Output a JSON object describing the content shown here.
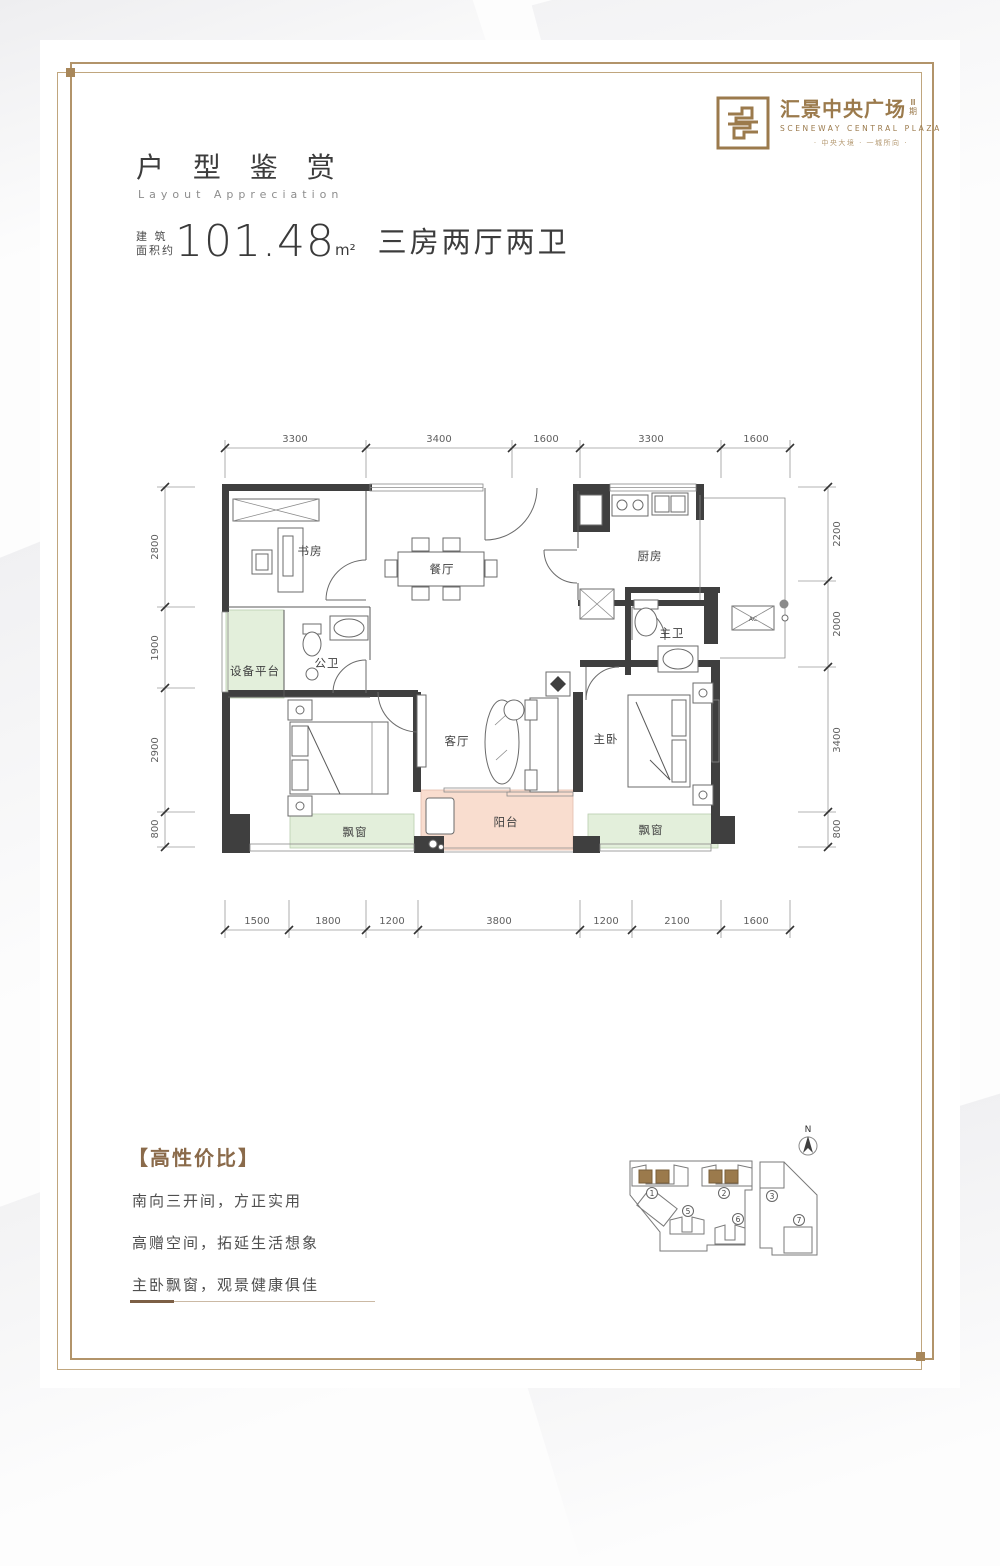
{
  "header": {
    "logo": {
      "name": "汇景中央广场",
      "phase": "Ⅲ期",
      "name_en": "SCENEWAY CENTRAL PLAZA",
      "tagline": "· 中央大境 · 一城所向 ·"
    },
    "title": "户 型 鉴 赏",
    "subtitle": "Layout Appreciation",
    "area_label_top": "建 筑",
    "area_label_bottom": "面积约",
    "area_value": "101.48",
    "area_unit": "m²",
    "layout_type": "三房两厅两卫"
  },
  "floorplan": {
    "rooms": {
      "study": "书房",
      "dining": "餐厅",
      "kitchen": "厨房",
      "equipment": "设备平台",
      "guest_bath": "公卫",
      "master_bath": "主卫",
      "living": "客厅",
      "master_bed": "主卧",
      "balcony": "阳台",
      "bay_window_left": "飘窗",
      "bay_window_right": "飘窗"
    },
    "ac_label": "AC",
    "dims_top": [
      "3300",
      "3400",
      "1600",
      "3300",
      "1600"
    ],
    "dims_bottom": [
      "1500",
      "1800",
      "1200",
      "3800",
      "1200",
      "2100",
      "1600"
    ],
    "dims_left": [
      "2800",
      "1900",
      "2900",
      "800"
    ],
    "dims_right": [
      "2200",
      "2000",
      "3400",
      "800"
    ]
  },
  "highlights": {
    "title": "【高性价比】",
    "items": [
      "南向三开间，方正实用",
      "高赠空间，拓延生活想象",
      "主卧飘窗，观景健康俱佳"
    ]
  },
  "site_plan": {
    "north": "N",
    "buildings": [
      "1",
      "2",
      "3",
      "5",
      "6",
      "7"
    ]
  },
  "colors": {
    "frame_gold": "#b2946a",
    "logo_gold": "#9b7a4c",
    "wall_dark": "#3f3f3f",
    "bay_green": "#e3efdb",
    "balcony_pink": "#f9ddcf",
    "highlight_brown": "#8a6a4a"
  }
}
